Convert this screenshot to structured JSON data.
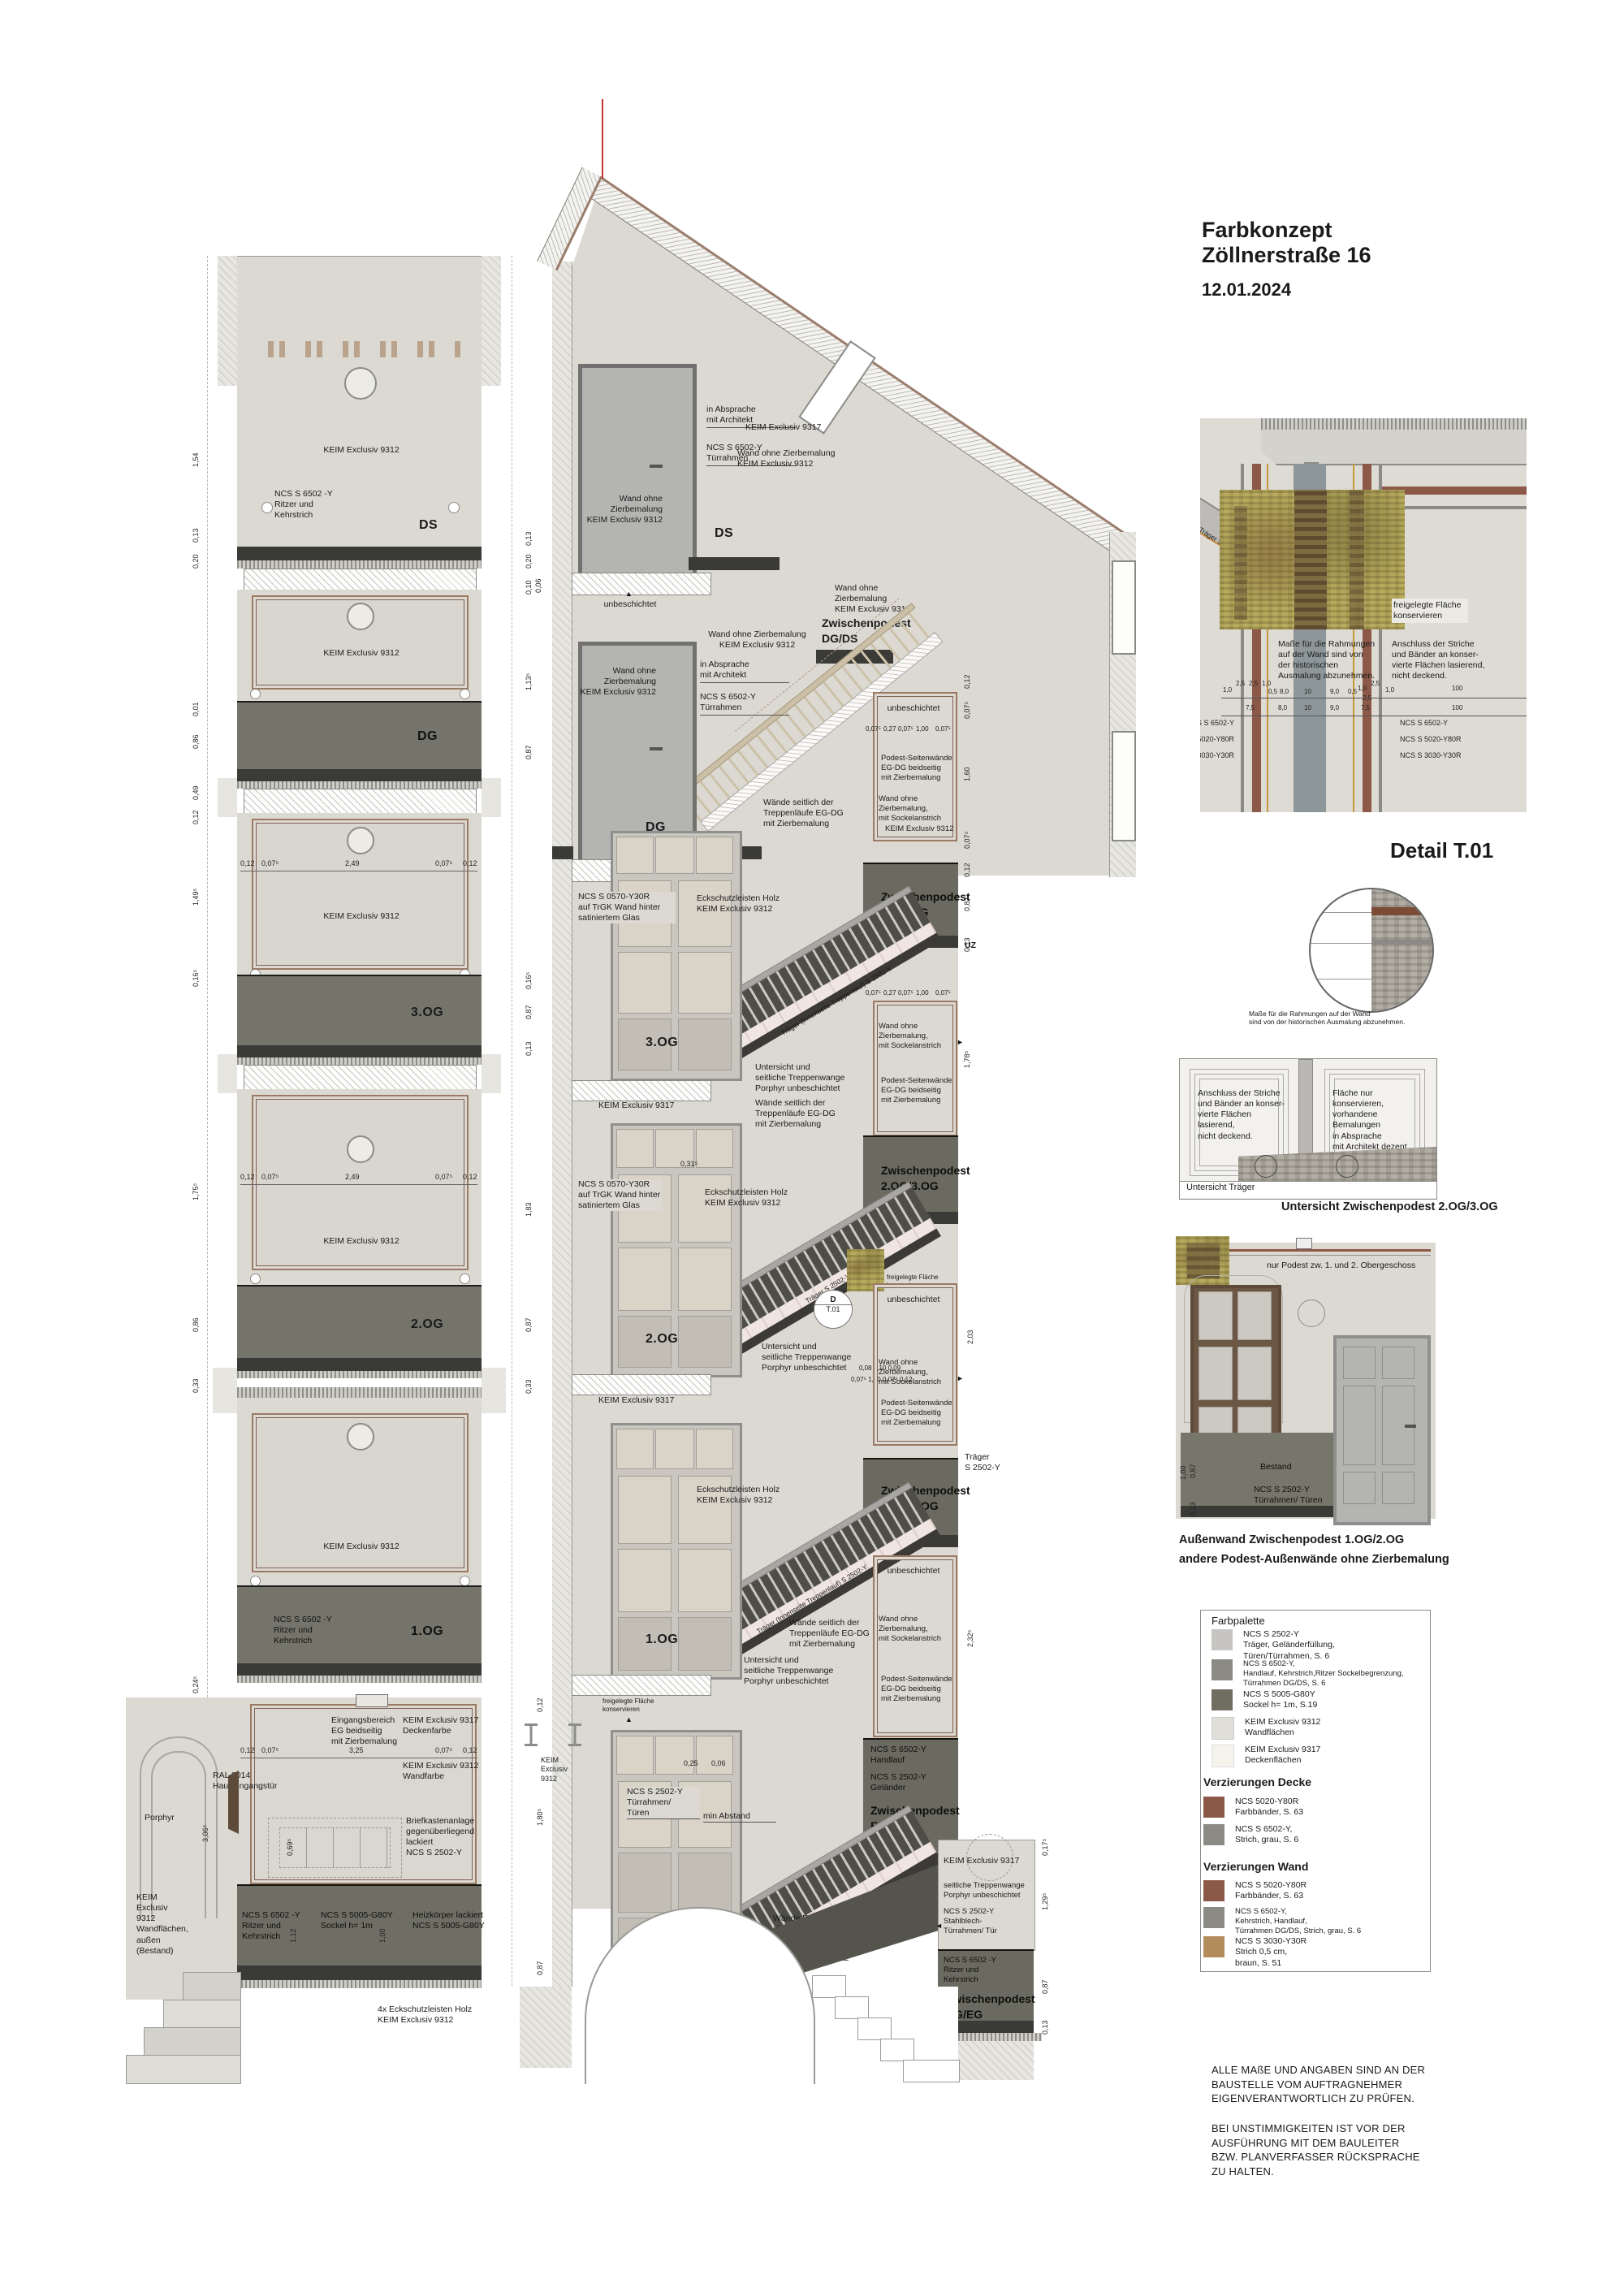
{
  "header": {
    "title1": "Farbkonzept",
    "title2": "Zöllnerstraße 16",
    "date": "12.01.2024"
  },
  "floors": [
    "DS",
    "DG",
    "3.OG",
    "2.OG",
    "1.OG",
    "EG"
  ],
  "zw": [
    "Zwischenpodest\nDG/DS",
    "Zwischenpodest\n3.OG/DG",
    "Zwischenpodest\n2.OG/3.OG",
    "Zwischenpodest\n1.OG/2.OG",
    "Zwischenpodest\nEG/1.OG",
    "Zwischenpodest\nKG/EG"
  ],
  "labels": {
    "keim9312": "KEIM Exclusiv 9312",
    "keim9317": "KEIM Exclusiv 9317",
    "keim9312_v": "KEIM\nExclusiv\n9312",
    "unbeschichtet": "unbeschichtet",
    "uz": "UZ",
    "wand_ohne": "Wand ohne Zierbemalung\nKEIM Exclusiv 9312",
    "wand_ohne_small": "Wand ohne\nZierbemalung\nKEIM Exclusiv 9312",
    "wand_ohne_sockel": "Wand ohne Zierbemalung,\nmit Sockelanstrich",
    "podest_seiten": "Podest-Seitenwände\nEG-DG beidseitig\nmit Zierbemalung",
    "waende_seitlich": "Wände seitlich der\nTreppenläufe EG-DG\nmit Zierbemalung",
    "untersicht_wange": "Untersicht und\nseitliche Treppenwange\nPorphyr unbeschichtet",
    "eckschutz": "Eckschutzleisten Holz\nKEIM Exclusiv 9312",
    "eckschutz4": "4x Eckschutzleisten Holz\nKEIM Exclusiv 9312",
    "absprache": "in Absprache\nmit Architekt",
    "tuerrahmen6502": "NCS S 6502-Y\nTürrahmen",
    "glas": "NCS S 0570-Y30R\nauf TrGK Wand hinter\nsatiniertem Glas",
    "freigelegt": "freigelegte Fläche\nkonservieren",
    "min_abstand": "min Abstand",
    "ritzer6502": "NCS S 6502 -Y\nRitzer und\nKehrstrich",
    "traeger_innen": "Träger (Innenseite Treppenlauf) S 2502-Y",
    "traeger_s": "Träger S 2502-Y",
    "traeger_s2": "Träger\nS 2502-Y",
    "handlauf": "NCS S 6502-Y\nHandlauf",
    "gelaender": "NCS S 2502-Y\nGeländer",
    "tueren2502": "NCS S 2502-Y\nTürrahmen/\nTüren",
    "stahlblech": "NCS S 2502-Y\nStahlblech-\nTürrahmen/ Tür",
    "wange_porphyr": "seitliche Treppenwange\nPorphyr unbeschichtet",
    "waende_hof": "Wände EG-UG/Ausgang Hof\nohne Zierbemalung",
    "d_marker": "D",
    "t01_marker": "T.01"
  },
  "elevation": {
    "eingang": "Eingangsbereich\nEG beidseitig\nmit Zierbemalung",
    "deckenfarbe": "KEIM Exclusiv 9317\nDeckenfarbe",
    "wandfarbe": "KEIM Exclusiv 9312\nWandfarbe",
    "ral": "RAL 8014\nHauseingangstür",
    "briefkasten": "Briefkastenanlage\ngegenüberliegend\nlackiert\nNCS S 2502-Y",
    "porphyr": "Porphyr",
    "bestand_wand": "KEIM\nExclusiv\n9312\nWandflächen,\naußen\n(Bestand)",
    "sockel": "NCS S 5005-G80Y\nSockel h= 1m",
    "heizkoerper": "Heizkörper lackiert\nNCS S 5005-G80Y"
  },
  "t01": {
    "title": "Detail T.01",
    "masse": "Maße für die Rahmungen\nauf der Wand sind von\nder historischen\nAusmalung abzunehmen.",
    "anschluss": "Anschluss der Striche\nund Bänder an konser-\nvierte Flächen lasierend,\nnicht deckend.",
    "row1": [
      "1,0",
      "2,5",
      "2,5",
      "1,0",
      "0,5",
      "8,0",
      "10",
      "9,0",
      "0,5",
      "1,0",
      "2,5",
      "1,0",
      "100"
    ],
    "row1b": "2,5",
    "row2": [
      "7,5",
      "8,0",
      "10",
      "9,0",
      "7,5",
      "100"
    ],
    "ncs": [
      "NCS S 6502-Y",
      "NCS S 5020-Y80R",
      "NCS S 3030-Y30R"
    ]
  },
  "untersicht": {
    "masse2": "Maße für die Rahmungen auf der Wand\nsind von der historischen Ausmalung abzunehmen.",
    "flaeche": "Fläche nur konservieren,\nvorhandene Bemalungen\nin Absprache\nmit Architekt dezent\nergänzen.",
    "untersicht_traeger": "Untersicht Träger",
    "caption": "Untersicht Zwischenpodest 2.OG/3.OG"
  },
  "aussenwand": {
    "nur_podest": "nur Podest zw. 1. und 2. Obergeschoss",
    "bestand": "Bestand",
    "tueren": "NCS S 2502-Y\nTürrahmen/ Türen",
    "caption1": "Außenwand Zwischenpodest 1.OG/2.OG",
    "caption2": "andere Podest-Außenwände ohne Zierbemalung",
    "dims": [
      "1,00",
      "0,87",
      "0,13"
    ]
  },
  "legend": {
    "title": "Farbpalette",
    "palette": [
      {
        "code": "NCS S 2502-Y",
        "desc": "Träger, Geländerfüllung,\nTüren/Türrahmen, S. 6",
        "color": "#c6c5c1"
      },
      {
        "code": "NCS S 6502-Y,",
        "desc": "Handlauf, Kehrstrich,Ritzer Sockelbegrenzung,\nTürrahmen DG/DS, S. 6",
        "color": "#8b8a85"
      },
      {
        "code": "NCS S 5005-G80Y",
        "desc": "Sockel h= 1m, S.19",
        "color": "#6f6e60"
      },
      {
        "code": "KEIM Exclusiv 9312",
        "desc": "Wandflächen",
        "color": "#dfded7"
      },
      {
        "code": "KEIM Exclusiv 9317",
        "desc": "Deckenflächen",
        "color": "#f4f3ec"
      }
    ],
    "decke_title": "Verzierungen Decke",
    "decke": [
      {
        "code": "NCS 5020-Y80R",
        "desc": "Farbbänder, S. 63",
        "color": "#8c5847"
      },
      {
        "code": "NCS S 6502-Y,",
        "desc": "Strich, grau, S. 6",
        "color": "#8b8a85"
      }
    ],
    "wand_title": "Verzierungen Wand",
    "wand": [
      {
        "code": "NCS S 5020-Y80R",
        "desc": "Farbbänder, S. 63",
        "color": "#8c5847"
      },
      {
        "code": "NCS S 6502-Y,",
        "desc": "Kehrstrich, Handlauf,\nTürrahmen DG/DS, Strich, grau, S. 6",
        "color": "#8b8a85"
      },
      {
        "code": "NCS S 3030-Y30R",
        "desc": "Strich 0,5 cm,\nbraun, S. 51",
        "color": "#b38c5c"
      }
    ]
  },
  "notes": {
    "p1": "ALLE  MAßE UND ANGABEN SIND AN DER\nBAUSTELLE VOM AUFTRAGNEHMER\nEIGENVERANTWORTLICH ZU PRÜFEN.",
    "p2": "BEI UNSTIMMIGKEITEN IST VOR DER\nAUSFÜHRUNG MIT DEM BAULEITER\nBZW. PLANVERFASSER RÜCKSPRACHE\nZU HALTEN."
  },
  "dims": {
    "elev_row": [
      "0,12",
      "0,07⁵",
      "2,49",
      "0,07⁵",
      "0,12"
    ],
    "eg_row": [
      "0,12",
      "0,07⁵",
      "3,25",
      "0,07⁵",
      "0,12"
    ],
    "pod_row": [
      "0,07⁵",
      "0,27",
      "0,07⁵",
      "1,00",
      "0,07⁵"
    ],
    "sec_small1": "0,08  0,10  0,09",
    "sec_small2": "0,07⁵   1,00   0,07⁵   0,12",
    "left": [
      "1,54",
      "0,20",
      "0,13",
      "0,01",
      "0,86",
      "0,49",
      "0,12",
      "1,49⁵",
      "0,16⁵",
      "1,75⁵",
      "0,86",
      "0,33",
      "0,24⁵",
      "3,06⁵",
      "1,12",
      "1,00",
      "0,69⁵"
    ],
    "right": [
      "0,13",
      "0,20",
      "0,06",
      "0,10",
      "1,13⁵",
      "0,87",
      "0,16⁵",
      "0,87",
      "0,13",
      "1,83",
      "0,87",
      "0,33",
      "0,12",
      "1,80⁵",
      "0,87"
    ],
    "sec": [
      "0,12",
      "0,07⁵",
      "1,60",
      "0,07⁵",
      "0,12",
      "0,87",
      "0,13",
      "1,78⁵",
      "2,03",
      "2,32⁵",
      "0,17⁵",
      "1,29⁵",
      "0,87",
      "0,13",
      "0,31⁵",
      "0,25",
      "0,06"
    ]
  }
}
